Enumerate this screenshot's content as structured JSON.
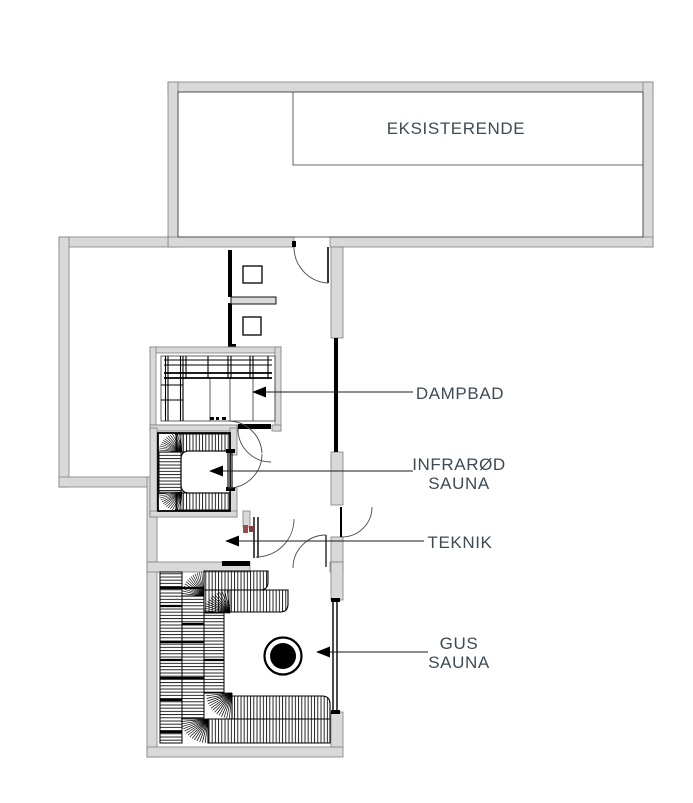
{
  "drawing": {
    "type": "architectural-floor-plan",
    "existing_room": {
      "label": "EKSISTERENDE"
    },
    "annotations": [
      {
        "id": "dampbad",
        "lines": [
          "DAMPBAD"
        ],
        "arrow": "points-left-into-steam-bath-room"
      },
      {
        "id": "infraroed-sauna",
        "lines": [
          "INFRARØD",
          "SAUNA"
        ],
        "arrow": "points-left-into-infrared-sauna"
      },
      {
        "id": "teknik",
        "lines": [
          "TEKNIK"
        ],
        "arrow": "points-left-into-technical-room"
      },
      {
        "id": "gus-sauna",
        "lines": [
          "GUS",
          "SAUNA"
        ],
        "arrow": "points-left-at-sauna-stove"
      }
    ],
    "features": {
      "stove": "round sauna stove in GUS SAUNA",
      "toilet_fixtures": 2,
      "doors_with_swing_arcs": 6,
      "benches": "slatted benches in DAMPBAD, INFRARØD SAUNA and GUS SAUNA"
    },
    "colors": {
      "wall_fill": "#d9d9d9",
      "wall_outline": "#7f7f7f",
      "drawing_line": "#1a1a1a",
      "label_text": "#3e4b54",
      "hinge_marker": "#a04a4c",
      "background": "#ffffff"
    }
  }
}
